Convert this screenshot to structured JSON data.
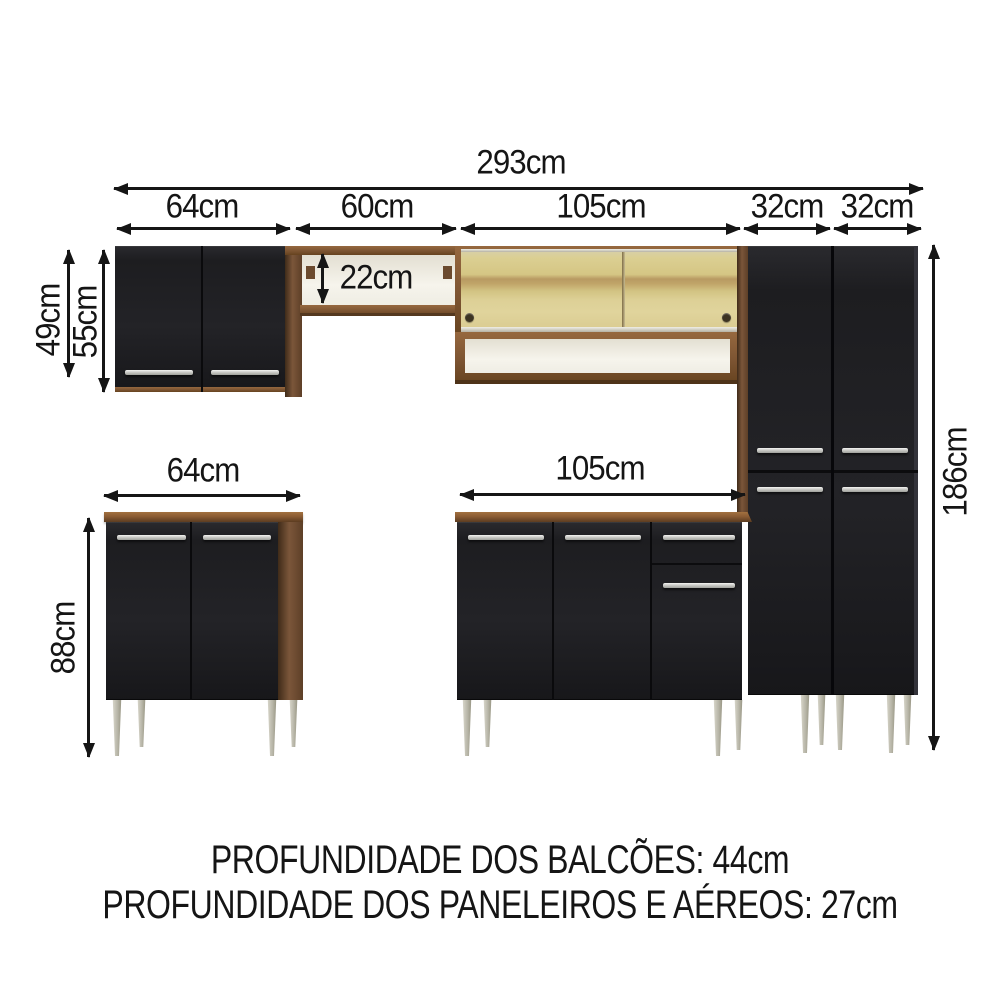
{
  "diagram": {
    "title": "kitchen cabinet set dimension diagram",
    "dims": {
      "total_width": "293cm",
      "upper_left_cabinet_width": "64cm",
      "upper_shelf_width": "60cm",
      "upper_glass_cabinet_width": "105cm",
      "tall_cabinet_left_width": "32cm",
      "tall_cabinet_right_width": "32cm",
      "upper_door_height": "49cm",
      "upper_cabinet_height": "55cm",
      "shelf_opening_height": "22cm",
      "base_left_cabinet_width": "64cm",
      "base_middle_cabinet_width": "105cm",
      "base_cabinet_height": "88cm",
      "tall_cabinet_height": "186cm"
    },
    "footer": {
      "line1": "PROFUNDIDADE DOS BALCÕES: 44cm",
      "line2": "PROFUNDIDADE DOS PANELEIROS E AÉREOS: 27cm"
    },
    "colors": {
      "cabinet_black": "#202023",
      "wood_brown": "#7b563a",
      "counter_brown": "#8a5c34",
      "glass_amber": "#d5c684",
      "interior_white": "#f4f1e9",
      "handle_silver": "#cfcfcb",
      "leg_silver": "#b8b6a8",
      "dimension_line": "#151515",
      "background": "#ffffff"
    }
  }
}
